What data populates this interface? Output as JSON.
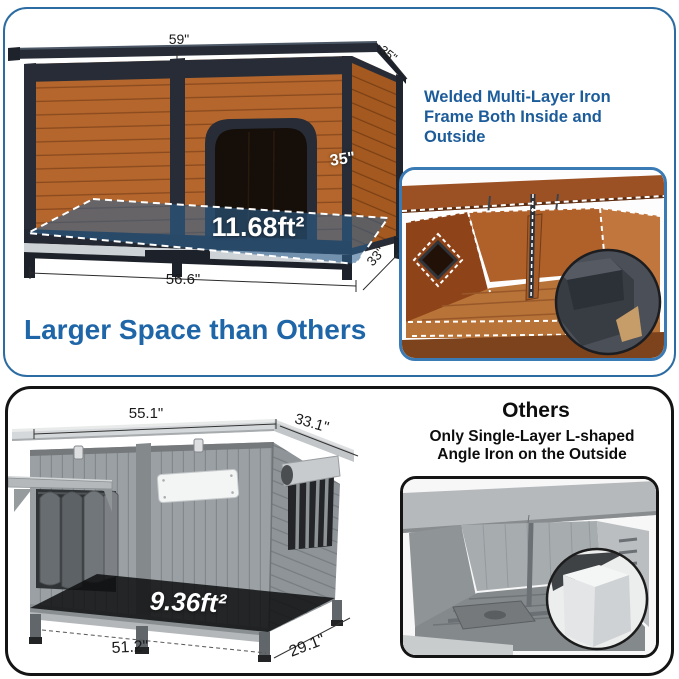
{
  "top_panel": {
    "heading_lines": [
      "Welded Multi-Layer Iron",
      "Frame Both Inside and",
      "Outside"
    ],
    "tagline": "Larger Space than Others",
    "dim_width_top": "59\"",
    "dim_roof_depth": "35\"",
    "dim_height": "35\"",
    "floor_area": "11.68ft²",
    "dim_width_bottom": "56.6\"",
    "dim_depth_bottom": "33\""
  },
  "bottom_panel": {
    "others_title": "Others",
    "others_sub_lines": [
      "Only Single-Layer L-shaped",
      "Angle Iron on the Outside"
    ],
    "dim_width_top": "55.1\"",
    "dim_depth_top": "33.1\"",
    "floor_area": "9.36ft²",
    "dim_width_bottom": "51.2\"",
    "dim_depth_bottom": "29.1\""
  },
  "colors": {
    "accent_heading_blue": "#1d5c9a",
    "tagline_blue": "#1e66a8",
    "panel_border_blue": "#2d6ca3",
    "image_border_blue": "#3a7ab5",
    "panel_border_dark": "#141414",
    "floor_highlight_blue": "#2e6391",
    "wood_brown": "#b4662c",
    "iron_frame_dark": "#272c36",
    "gray_body": "#9aa0a3"
  }
}
